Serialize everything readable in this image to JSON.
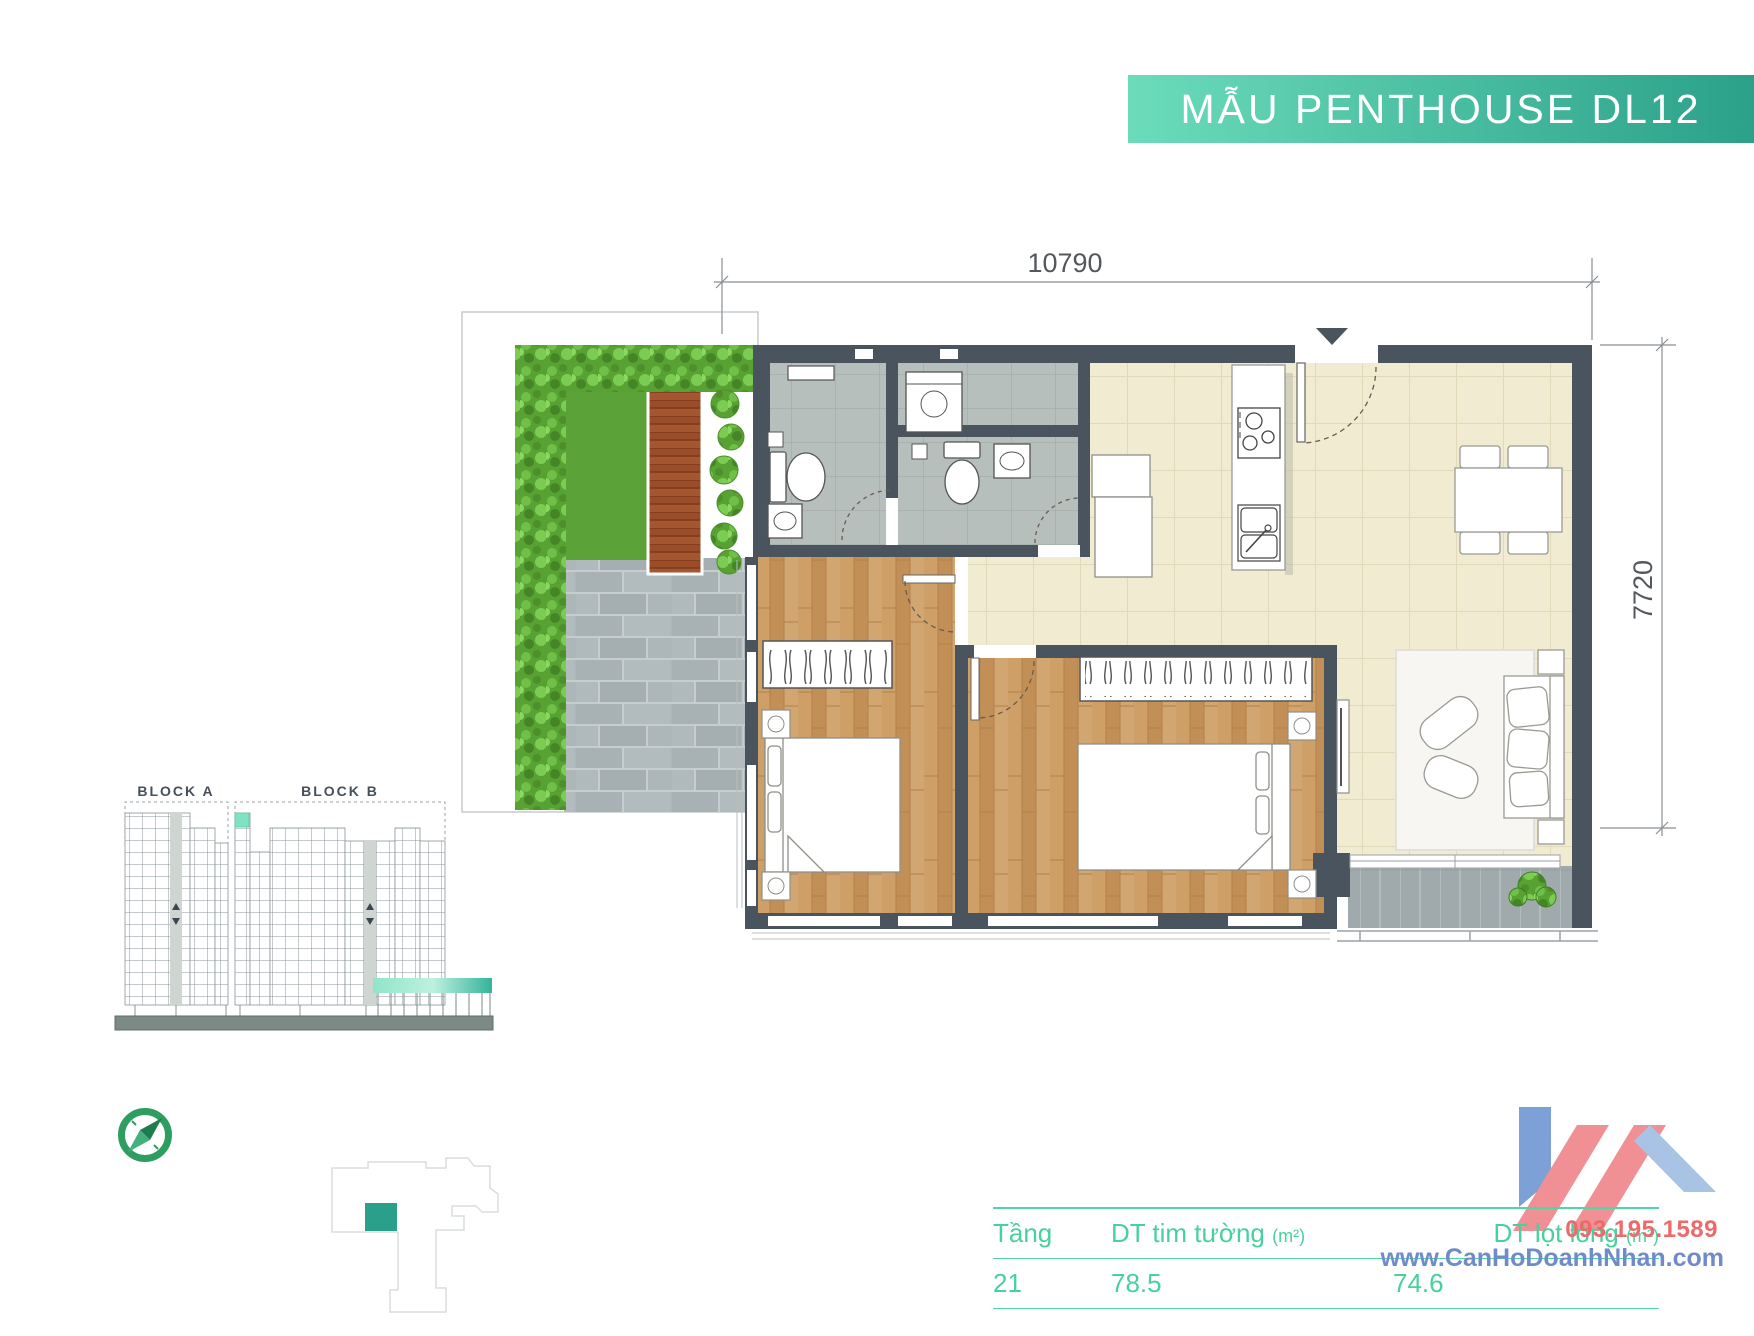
{
  "title_banner": {
    "text": "MẪU PENTHOUSE DL12"
  },
  "dimensions": {
    "width_mm": "10790",
    "height_mm": "7720"
  },
  "block_diagram": {
    "block_a_label": "BLOCK A",
    "block_b_label": "BLOCK B"
  },
  "info_table": {
    "columns": [
      {
        "label": "Tầng",
        "unit": ""
      },
      {
        "label": "DT tim tường",
        "unit": "(m²)"
      },
      {
        "label": "DT lọt lòng",
        "unit": "(m²)"
      }
    ],
    "rows": [
      {
        "floor": "21",
        "gross_area": "78.5",
        "net_area": "74.6"
      }
    ]
  },
  "watermark": {
    "phone": "093.195.1589",
    "website": "www.CanHoDoanhNhan.com"
  },
  "colors": {
    "accent_mint": "#6bdcba",
    "accent_teal": "#2ba18a",
    "table_green": "#46d19e",
    "wall_dark": "#4a545e",
    "watermark_red": "#ee6a6a",
    "watermark_blue": "#6f8bca",
    "highlight_unit_teal": "#2aa08a"
  }
}
